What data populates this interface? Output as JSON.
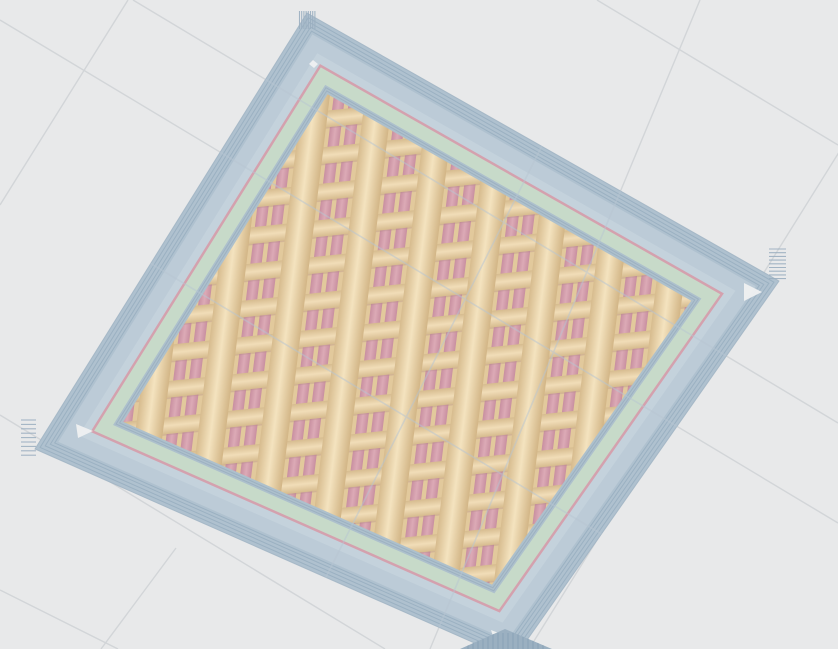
{
  "app": {
    "name": "slicer-3d-preview-viewport",
    "description": "Sliced flat square plate shown in layer preview on build plate, grid infill"
  },
  "scene": {
    "width": 838,
    "height": 649,
    "background_color": "#e8e9ea",
    "grid": {
      "line_color": "#d2d5d8",
      "line_width": 1.4,
      "background_lines": [
        [
          597,
          0,
          838,
          145
        ],
        [
          133,
          0,
          838,
          423
        ],
        [
          0,
          20,
          838,
          523
        ],
        [
          0,
          415,
          385,
          649
        ],
        [
          0,
          590,
          118,
          649
        ],
        [
          128,
          0,
          0,
          205
        ],
        [
          700,
          0,
          430,
          649
        ],
        [
          934,
          0,
          529,
          649
        ],
        [
          176,
          548,
          101,
          649
        ]
      ],
      "overlay_line_color": "#b7c5d2",
      "overlay_line_width": 1.6,
      "overlay_opacity": 0.5,
      "overlay_lines": [
        [
          133,
          0,
          838,
          423
        ],
        [
          0,
          173,
          793,
          649
        ],
        [
          0,
          20,
          838,
          523
        ],
        [
          700,
          0,
          430,
          649
        ],
        [
          615,
          0,
          290,
          649
        ]
      ]
    },
    "object": {
      "corners": [
        [
          307,
          13
        ],
        [
          779,
          281
        ],
        [
          513,
          660
        ],
        [
          35,
          449
        ]
      ],
      "outline": {
        "color": "#9db1c2",
        "width": 1,
        "opacity": 0.8
      },
      "rings": [
        {
          "name": "outer-ridge-band",
          "inset": 0,
          "fill": "#afc1cf"
        },
        {
          "name": "wall-top-band",
          "inset": 16,
          "fill": "#bccbd7"
        },
        {
          "name": "wall-top-inner-light",
          "inset": 30,
          "fill": "#c4d2dc"
        },
        {
          "name": "pink-perimeter-ring",
          "inset": 38,
          "fill": "#d4a1ae"
        },
        {
          "name": "green-inner-wall-ring",
          "inset": 40.5,
          "fill": "#c7dac9"
        },
        {
          "name": "inner-face-band",
          "inset": 53.5,
          "fill": "#adc0cc"
        },
        {
          "name": "infill-area",
          "inset": 60.5,
          "fill": "@pattern"
        }
      ],
      "stripe_sets": [
        {
          "name": "ridge-lines",
          "insets": [
            3.5,
            7,
            10.5,
            13.5
          ],
          "color": "#98aec0",
          "width": 1,
          "opacity": 0.85
        },
        {
          "name": "inner-face-lines",
          "insets": [
            55.6,
            58
          ],
          "color": "#96abbd",
          "width": 1,
          "opacity": 0.7
        }
      ],
      "pattern": {
        "tile_w": 64,
        "tile_h": 37,
        "transform": "matrix(0.9945,-0.1045,-0.1219,0.9925,0,0)",
        "base_fill": "#e2c99c",
        "pink_cols": {
          "xs": [
            0,
            16,
            32,
            48
          ],
          "w": 11.5,
          "colors": [
            "#c88fa0",
            "#dcaab6",
            "#c88fa0"
          ]
        },
        "shadow": {
          "y": 17,
          "h": 1.3,
          "color": "#b08a84",
          "opacity": 0.35
        },
        "bar": {
          "h": 17,
          "colors": [
            "#d6bb8e",
            "#f1ddb8",
            "#d6bb8e"
          ]
        },
        "tube": {
          "w": 30,
          "colors": [
            "#d2b586",
            "#f4e3bf",
            "#d2b586"
          ]
        }
      },
      "seam_combs": {
        "color": "#9bafc0",
        "width": 1.1,
        "opacity": 0.9,
        "items": [
          {
            "name": "seam-comb-top",
            "x": 299.5,
            "y": 11,
            "count": 8,
            "step": [
              2.2,
              0
            ],
            "dir": [
              0,
              1
            ],
            "len": 18
          },
          {
            "name": "seam-comb-right",
            "x": 769,
            "y": 249,
            "count": 9,
            "step": [
              0,
              3.7
            ],
            "dir": [
              1,
              0
            ],
            "len": 17
          },
          {
            "name": "seam-comb-left",
            "x": 21,
            "y": 420,
            "count": 9,
            "step": [
              0,
              4.4
            ],
            "dir": [
              1,
              0
            ],
            "len": 15
          }
        ]
      },
      "corner_gaps": {
        "fill": "#eff0f1",
        "opacity": 0.95,
        "items": [
          {
            "name": "gap-top",
            "points": [
              [
                313,
                60
              ],
              [
                318,
                64
              ],
              [
                314,
                68
              ],
              [
                309,
                64
              ]
            ]
          },
          {
            "name": "gap-right",
            "points": [
              [
                744,
                283
              ],
              [
                762,
                292
              ],
              [
                744,
                301
              ]
            ]
          },
          {
            "name": "gap-left",
            "points": [
              [
                76,
                424
              ],
              [
                93,
                431
              ],
              [
                78,
                438
              ]
            ]
          },
          {
            "name": "gap-bottom",
            "points": [
              [
                491,
                630
              ],
              [
                509,
                637
              ],
              [
                496,
                646
              ]
            ]
          }
        ]
      },
      "near_corner_piece": {
        "points": [
          [
            460,
            649
          ],
          [
            505,
            629
          ],
          [
            552,
            649
          ]
        ],
        "fill": "#9bb0c1",
        "stripe_color": "#8aa2b6",
        "stripe_step": 5,
        "stripe_x0": 468,
        "stripe_x1": 546,
        "stripe_y_top": 633
      }
    }
  }
}
